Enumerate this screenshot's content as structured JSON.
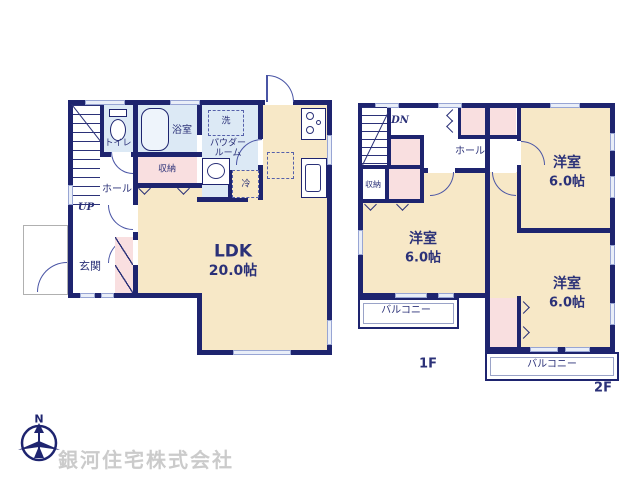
{
  "colors": {
    "wall_navy": "#1e246f",
    "text_navy": "#2b3178",
    "room_cream": "#f7e8c7",
    "wet_area_blue": "#dce9f5",
    "closet_pink": "#f9dfe0",
    "window_fill": "#e9eef8",
    "company_gray": "#cbcbcb"
  },
  "floor1": {
    "label": "1F",
    "ldk": {
      "name": "LDK",
      "size": "20.0帖"
    },
    "toilet": "トイレ",
    "bath": "浴室",
    "laundry": "洗",
    "powder_room_line1": "パウダー",
    "powder_room_line2": "ルーム",
    "storage": "収納",
    "hall": "ホール",
    "stairs_up": "UP",
    "entrance": "玄関",
    "fridge": "冷"
  },
  "floor2": {
    "label": "2F",
    "stairs_down": "DN",
    "hall": "ホール",
    "storage": "収納",
    "bedroom_top_right": {
      "name": "洋室",
      "size": "6.0帖"
    },
    "bedroom_left": {
      "name": "洋室",
      "size": "6.0帖"
    },
    "bedroom_bottom_right": {
      "name": "洋室",
      "size": "6.0帖"
    },
    "balcony_left": "バルコニー",
    "balcony_bottom": "バルコニー"
  },
  "footer": {
    "company": "銀河住宅株式会社",
    "compass": "N"
  }
}
